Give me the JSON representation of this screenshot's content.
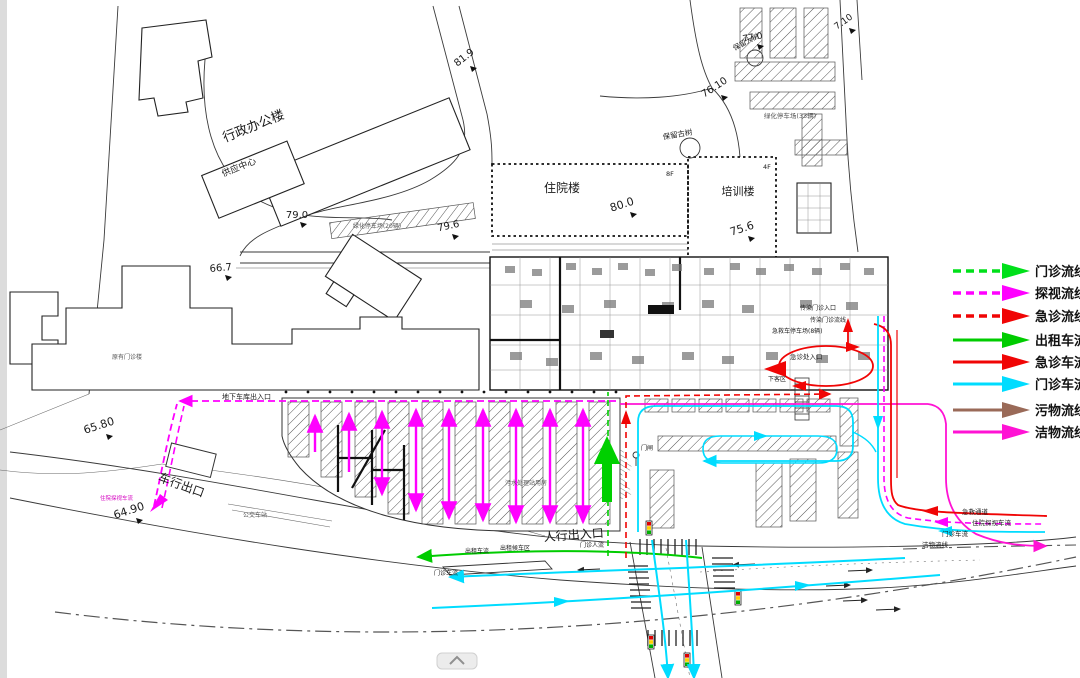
{
  "legend": {
    "items": [
      {
        "label": "门诊流线",
        "color": "#00e01a",
        "line": "dashed"
      },
      {
        "label": "探视流线",
        "color": "#ff00ff",
        "line": "dashed"
      },
      {
        "label": "急诊流线",
        "color": "#f00505",
        "line": "dashed"
      },
      {
        "label": "出租车流",
        "color": "#00cc00",
        "line": "solid"
      },
      {
        "label": "急诊车流",
        "color": "#f00505",
        "line": "solid"
      },
      {
        "label": "门诊车流",
        "color": "#00dcff",
        "line": "solid"
      },
      {
        "label": "污物流线",
        "color": "#9a6a58",
        "line": "solid"
      },
      {
        "label": "洁物流线",
        "color": "#ff12d4",
        "line": "solid"
      }
    ]
  },
  "buildings": {
    "admin_office": "行政办公楼",
    "supply_center": "供应中心",
    "inpatient": "住院楼",
    "inpatient_floors": "8F",
    "training": "培训楼",
    "training_floors": "4F",
    "existing_outpatient": "原有门诊楼"
  },
  "elevations": {
    "top_road": "81.9",
    "north1": "77.0",
    "north2": "76.10",
    "northeast": "7.10",
    "inpatient": "80.0",
    "training": "75.6",
    "admin_west": "79.0",
    "admin_east": "79.6",
    "west": "66.7",
    "southwest1": "65.80",
    "southwest2": "64.90"
  },
  "site_labels": {
    "tree_preserved_big": "保留大树",
    "tree_preserved_old": "保留古树",
    "green_parking_20": "绿化停车场(20辆)",
    "green_parking_33": "绿化停车场(33辆)",
    "garage_entrance": "地下车库出入口",
    "vehicle_exit": "车行出口",
    "inpatient_visit_flow_sw": "住院探视车流",
    "bus_station": "公交车站",
    "pedestrian_entrance": "人行出入口",
    "sewage_station": "污水处理站用房",
    "taxi_flow": "出租车流",
    "taxi_waiting_area": "出租候车区",
    "outpatient_people_flow": "门诊人流",
    "outpatient_vehicle_flow_sw": "门诊车流",
    "gate": "门闸",
    "infection_clinic_entrance": "传染门诊入口",
    "infection_clinic_flow": "传染门诊流线",
    "ambulance_parking": "急救车停车场(8辆)",
    "emergency_entrance": "急诊处入口",
    "dropoff_area": "下客区",
    "rescue_channel": "急救通道",
    "inpatient_visit_flow_se": "住院探视车流",
    "outpatient_vehicle_flow_se": "门诊车流",
    "clean_flow_se": "洁物流线"
  }
}
